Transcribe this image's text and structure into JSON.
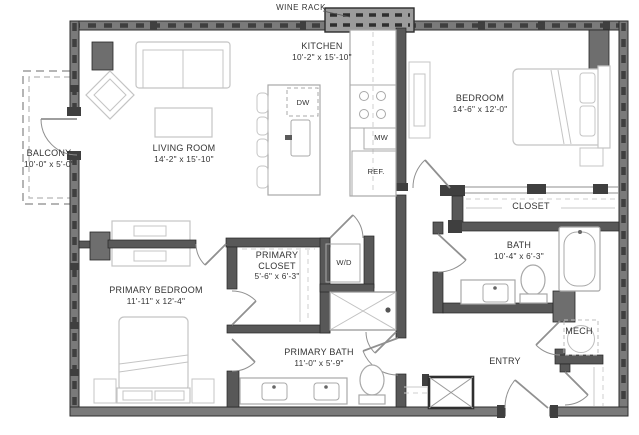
{
  "labels": {
    "wine_rack": "WINE RACK",
    "kitchen": {
      "name": "KITCHEN",
      "dims": "10'-2\" x 15'-10\""
    },
    "living_room": {
      "name": "LIVING ROOM",
      "dims": "14'-2\" x 15'-10\""
    },
    "bedroom": {
      "name": "BEDROOM",
      "dims": "14'-6\" x 12'-0\""
    },
    "balcony": {
      "name": "BALCONY",
      "dims": "10'-0\" x 5'-0\""
    },
    "closet": {
      "name": "CLOSET"
    },
    "bath": {
      "name": "BATH",
      "dims": "10'-4\" x 6'-3\""
    },
    "mech": {
      "name": "MECH"
    },
    "entry": {
      "name": "ENTRY"
    },
    "primary_bedroom": {
      "name": "PRIMARY BEDROOM",
      "dims": "11'-11\" x 12'-4\""
    },
    "primary_closet": {
      "name": "PRIMARY CLOSET",
      "dims": "5'-6\" x 6'-3\""
    },
    "primary_bath": {
      "name": "PRIMARY BATH",
      "dims": "11'-0\" x 5'-9\""
    },
    "washer_dryer": "W/D",
    "dishwasher": "DW",
    "microwave": "MW",
    "refrigerator": "REF."
  },
  "colors": {
    "wall_fill": "#7a7a7a",
    "wall_interior": "#585858",
    "wall_tab": "#3f3f3f",
    "column": "#6e6e6e",
    "furniture": "#c4c4c4",
    "fixture": "#a8a8a8",
    "door": "#909090",
    "text": "#333333",
    "wine_rack": "#9b9b9b",
    "background": "#ffffff"
  }
}
